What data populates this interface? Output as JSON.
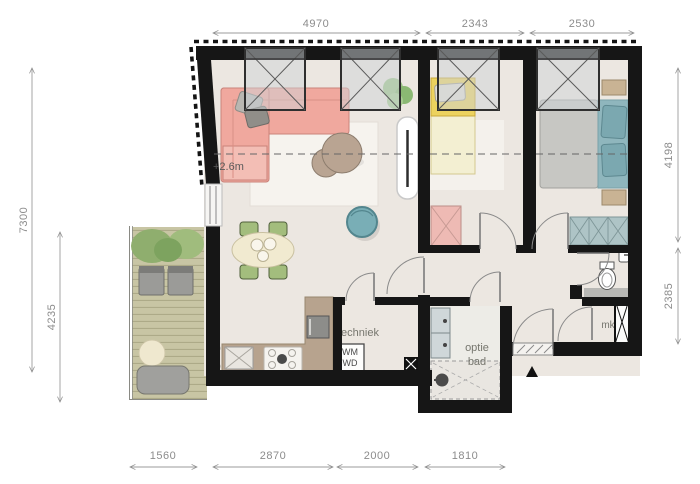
{
  "plan": {
    "labels": {
      "ceiling_height": "+2.6m",
      "techniek": "techniek",
      "washer": "WM",
      "dryer": "WD",
      "bath_option_line1": "optie",
      "bath_option_line2": "bad",
      "meter_closet": "mk"
    },
    "dimensions": {
      "top": [
        "4970",
        "2343",
        "2530"
      ],
      "left": [
        "7300",
        "4235"
      ],
      "right": [
        "4198",
        "2385"
      ],
      "bottom": [
        "1560",
        "2870",
        "2000",
        "1810"
      ]
    },
    "colors": {
      "wall": "#161616",
      "floor": "#ece7e1",
      "bathroom_floor": "#edece7",
      "rug": "#f6f3ee",
      "balcony_deck": "#c8c5a4",
      "plant": "#8fae6e",
      "sofa": "#f0a89e",
      "sofa_chaise": "#f3beb5",
      "lounge_chair": "#79aeb6",
      "dining_table": "#f1ead0",
      "dining_chair": "#a3bd7d",
      "kitchen_counter": "#b7a38e",
      "bed_single_head": "#ecd25e",
      "bed_single_blanket": "#f3efd2",
      "bed_double_duvet": "#c7c7c3",
      "bed_double_throw": "#8fb6bd",
      "wardrobe_pink": "#eebab4",
      "wardrobe_teal": "#aec4c6",
      "coffee_table": "#b9a492",
      "vanity": "#cfd7d9",
      "window_glass": "#cdd4d8",
      "dimension_text": "#8c8c8c"
    }
  }
}
